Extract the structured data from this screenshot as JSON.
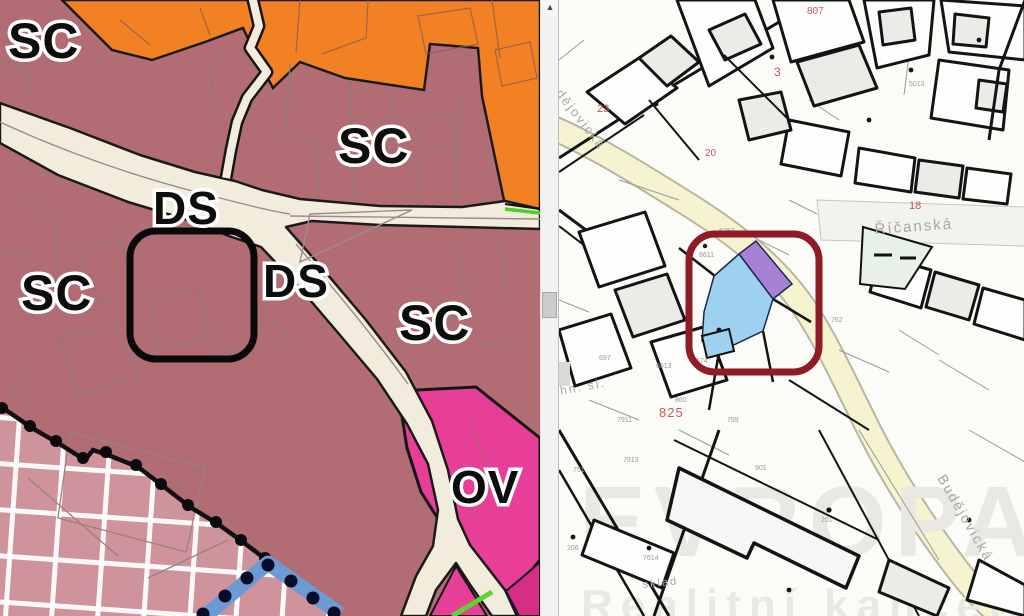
{
  "app": {
    "description": "Side-by-side zoning plan (left) and cadastral map with highlighted parcel (right)"
  },
  "left_map": {
    "labels": [
      "SC",
      "SC",
      "DS",
      "DS",
      "SC",
      "SC",
      "OV"
    ],
    "colors": {
      "sc_zone": "#b26d74",
      "orange_zone": "#f28123",
      "road": "#f2ecdd",
      "ov_zone": "#e73e97",
      "magenta_zone": "#d62e86",
      "hatched_zone": "#cf939b",
      "blue_band": "#6b9bd2",
      "green_line": "#5fd435",
      "highlight_outline": "#0a0a0a"
    }
  },
  "right_map": {
    "street_labels": {
      "budejovicka_top": "Budějovická",
      "budejovicka_bottom": "Budějovická",
      "ricanska": "Říčanská"
    },
    "area_labels": {
      "sklad": "sklad",
      "techn_sl": "chn. sl."
    },
    "red_parcel_numbers": [
      "807",
      "23",
      "3",
      "20",
      "18",
      "825"
    ],
    "gray_parcel_numbers": [
      "6287",
      "8611",
      "674",
      "762",
      "7911",
      "697",
      "6513",
      "860",
      "759",
      "7913",
      "751",
      "7614",
      "901",
      "5013",
      "201",
      "206"
    ],
    "watermark": {
      "line1": "EVROPA",
      "line2": "Realitní kancelář"
    },
    "colors": {
      "highlight_square": "#8e1b26",
      "selected_parcel_blue": "#9ed0f0",
      "selected_parcel_purple": "#a881d6",
      "teal_parcel": "#e7f1ea",
      "road_yellow": "#f6f3d0",
      "background": "#fbfbf8"
    }
  }
}
